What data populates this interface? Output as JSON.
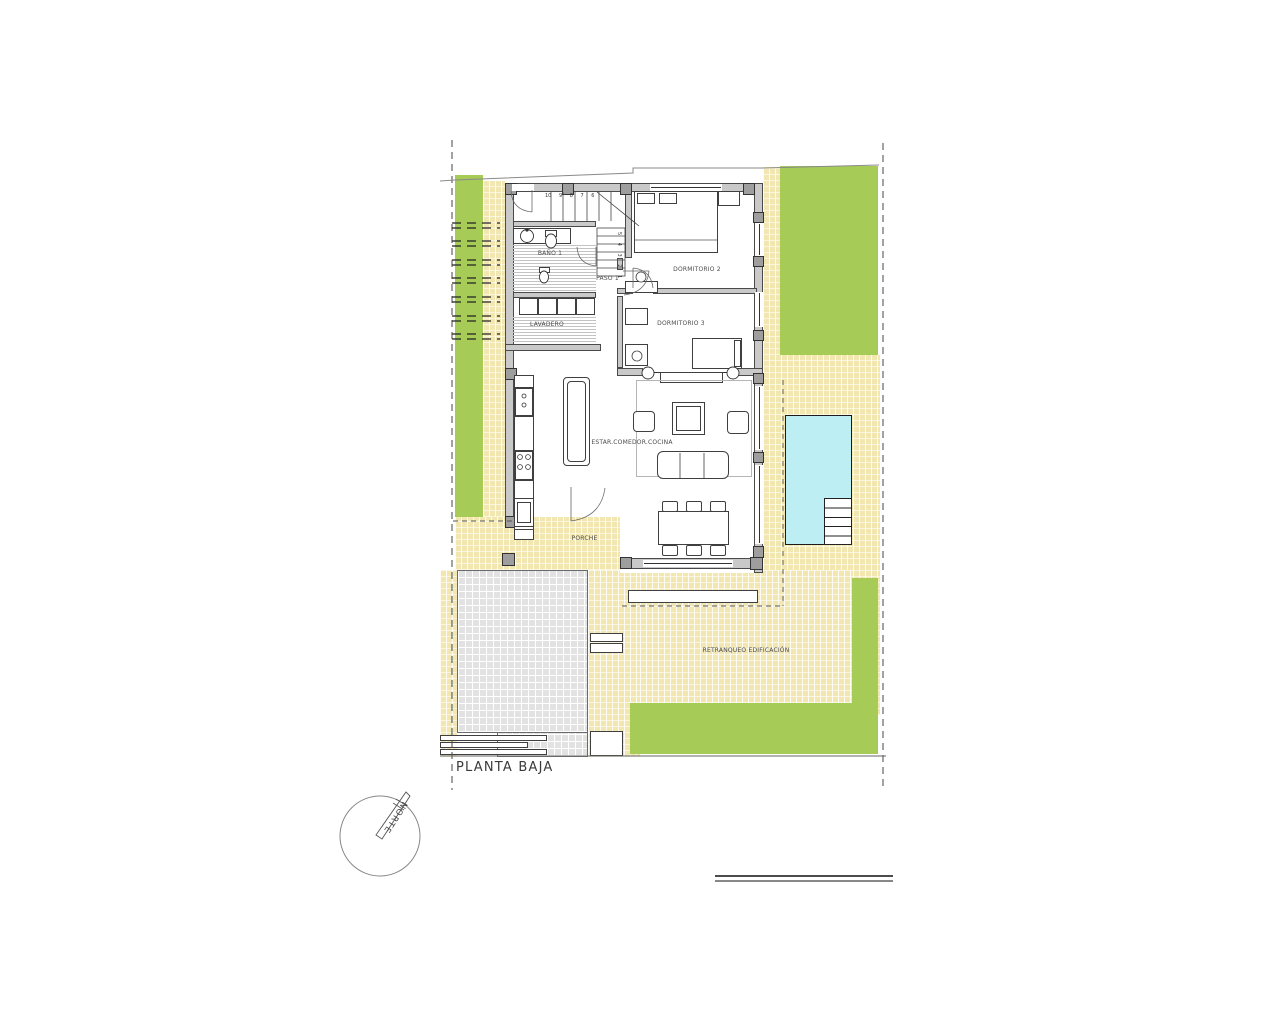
{
  "drawing": {
    "title": "PLANTA BAJA",
    "compass_label": "NORTE"
  },
  "rooms": {
    "bano1": "BAÑO 1",
    "paso": "PASO 1",
    "lavadero": "LAVADERO",
    "dormitorio2": "DORMITORIO 2",
    "dormitorio3": "DORMITORIO 3",
    "estar": "ESTAR.COMEDOR.COCINA",
    "porche": "PORCHE",
    "retranqueo": "RETRANQUEO EDIFICACIÓN"
  },
  "stairs": {
    "upper_numbers": "10 9 8 7 6",
    "lower_numbers": "5 4 3 2 1"
  },
  "colors": {
    "garden_green": "#a6cb57",
    "terrace_yellow": "#f2e7b0",
    "paving_gray": "#e2e2e2",
    "pool_blue": "#bdeef3",
    "wall_gray": "#c9c9c9"
  }
}
